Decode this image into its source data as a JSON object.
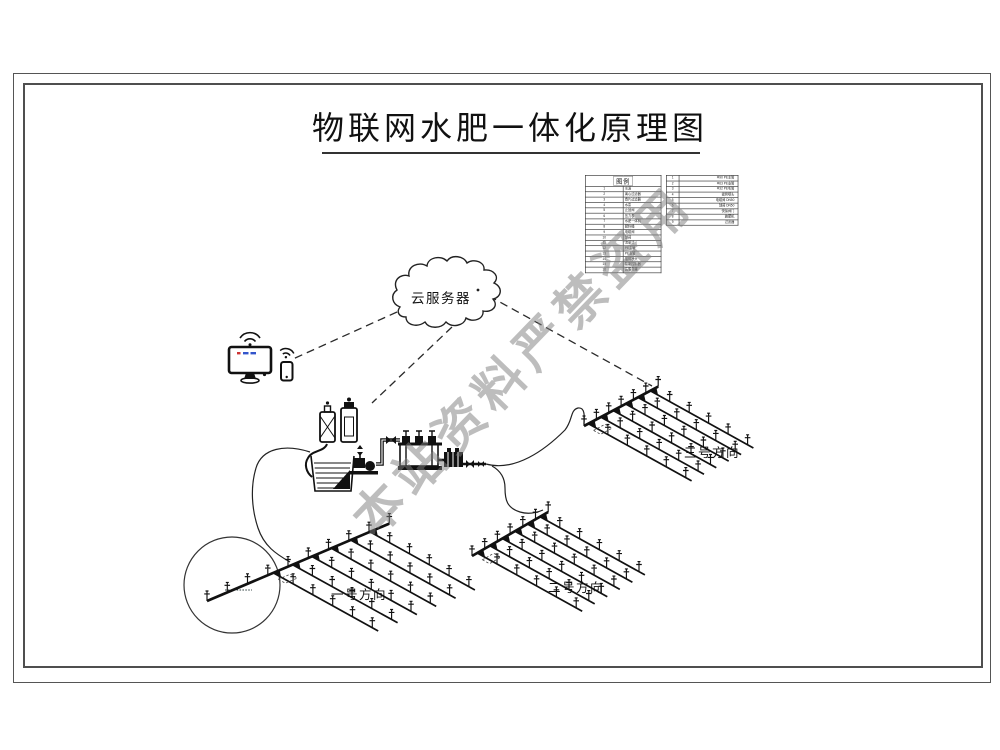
{
  "title": {
    "text": "物联网水肥一体化原理图"
  },
  "watermark": {
    "text": "本站资料严禁盗用",
    "color": "#7e7e7e"
  },
  "labels": {
    "cloud": "云服务器"
  },
  "colors": {
    "line": "#1a1a1a",
    "frame": "#4f4f4f",
    "watermark_gray": "#7e7e7e",
    "screen_red": "#cc3333",
    "screen_blue": "#3355cb"
  },
  "legend_table": {
    "header": "图例",
    "rows": [
      {
        "no": "1",
        "name": "水源"
      },
      {
        "no": "2",
        "name": "离心过滤器"
      },
      {
        "no": "3",
        "name": "叠片过滤器"
      },
      {
        "no": "4",
        "name": "水泵"
      },
      {
        "no": "5",
        "name": "止回阀"
      },
      {
        "no": "6",
        "name": "压力表"
      },
      {
        "no": "7",
        "name": "水肥一体机"
      },
      {
        "no": "8",
        "name": "肥料桶"
      },
      {
        "no": "9",
        "name": "电磁阀"
      },
      {
        "no": "10",
        "name": "球阀"
      },
      {
        "no": "11",
        "name": "流量计"
      },
      {
        "no": "12",
        "name": "PE主管"
      },
      {
        "no": "13",
        "name": "PE支管"
      },
      {
        "no": "14",
        "name": "摇臂喷头"
      },
      {
        "no": "15",
        "name": "智能控制器"
      },
      {
        "no": "16",
        "name": "云服务器"
      }
    ]
  },
  "spec_table": {
    "rows": [
      {
        "no": "1",
        "name": "Φ90 PE主管"
      },
      {
        "no": "2",
        "name": "Φ63 PE支管"
      },
      {
        "no": "3",
        "name": "Φ32 PE毛管"
      },
      {
        "no": "4",
        "name": "摇臂喷头"
      },
      {
        "no": "5",
        "name": "电磁阀 DN50"
      },
      {
        "no": "6",
        "name": "球阀 DN50"
      },
      {
        "no": "7",
        "name": "快接阀门"
      },
      {
        "no": "8",
        "name": "施肥机"
      },
      {
        "no": "9",
        "name": "过滤器"
      }
    ]
  },
  "diagram": {
    "fields": [
      {
        "id": "field-grid-1",
        "label": "一号方向",
        "label_pos": [
          331,
          599
        ],
        "origin": [
          207,
          601
        ],
        "main_angle": -23,
        "main_len": 198,
        "main_sprinklers": 10,
        "lat_start": 72,
        "lat_count": 6,
        "lat_spacing": 21,
        "lat_angle": 29,
        "lat_len": 120,
        "lat_sprinklers": 5
      },
      {
        "id": "field-grid-2",
        "label": "二号方向",
        "label_pos": [
          548,
          592
        ],
        "origin": [
          472,
          556
        ],
        "main_angle": -30,
        "main_len": 88,
        "main_sprinklers": 7,
        "lat_start": 6,
        "lat_count": 6,
        "lat_spacing": 14.5,
        "lat_angle": 29,
        "lat_len": 120,
        "lat_sprinklers": 5
      },
      {
        "id": "field-grid-3",
        "label": "三号方向",
        "label_pos": [
          684,
          457
        ],
        "origin": [
          584,
          426
        ],
        "main_angle": -28,
        "main_len": 84,
        "main_sprinklers": 7,
        "lat_start": 5,
        "lat_count": 6,
        "lat_spacing": 14,
        "lat_angle": 29,
        "lat_len": 118,
        "lat_sprinklers": 5
      }
    ]
  }
}
